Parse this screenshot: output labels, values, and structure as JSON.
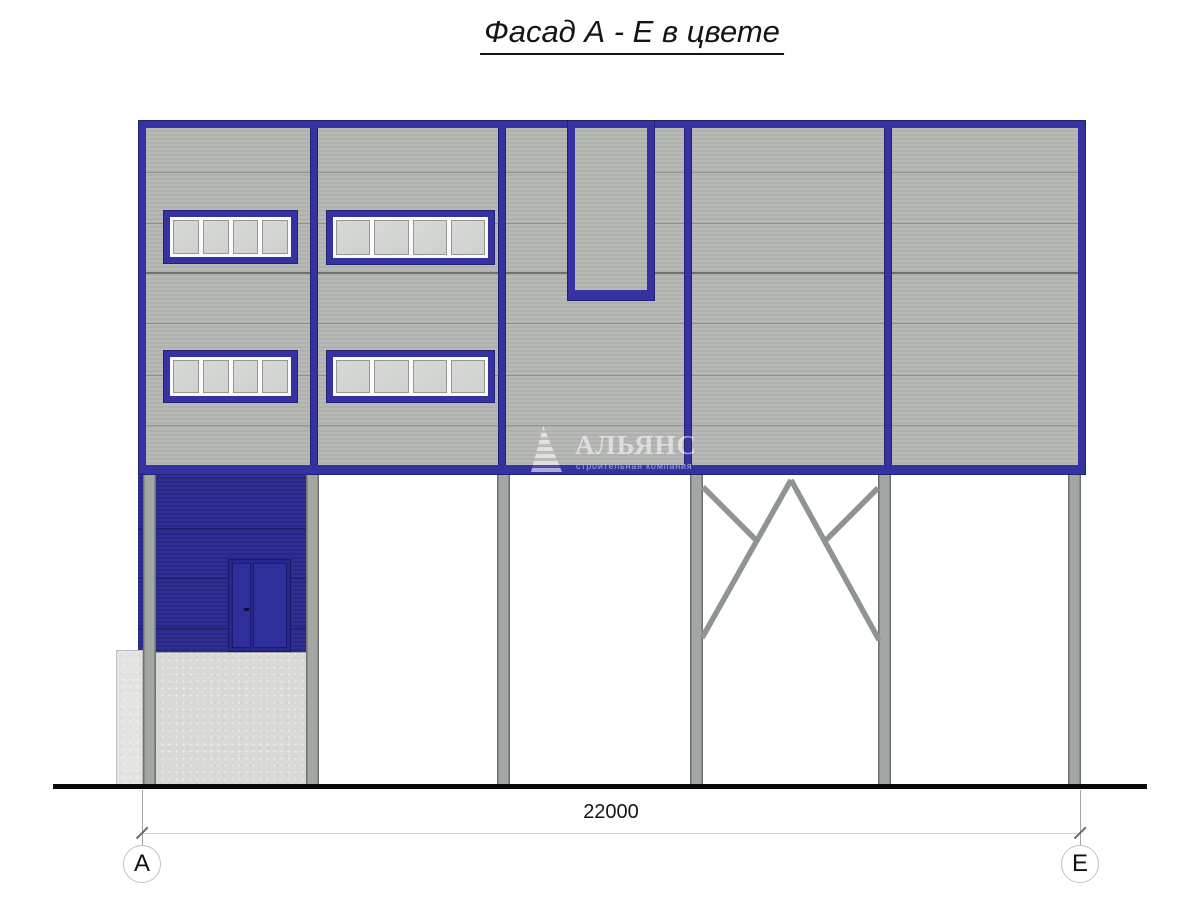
{
  "title": "Фасад А - Е в цвете",
  "drawing": {
    "type": "facade-elevation",
    "dimension": {
      "value": "22000"
    },
    "grid_markers": {
      "left": "А",
      "right": "Е"
    },
    "watermark": {
      "name": "АЛЬЯНС",
      "subtitle": "строительная компания"
    },
    "features": {
      "window_count": 4,
      "panes_per_window": 4,
      "support_columns": 6,
      "has_cross_bracing": true,
      "has_entrance_door": true
    }
  },
  "colors": {
    "frame_blue": "#3533a1",
    "frame_blue_dark": "#232270",
    "annex_blue": "#2b2b90",
    "door_blue": "#2f2f9b",
    "facade_gray": "#b2b5b1",
    "panel_line_gray": "#8d908d",
    "column_gray": "#a3a7a3",
    "brace_gray": "#8e948f",
    "concrete_gray": "#d9d9d7",
    "ground_black": "#0a0a0a",
    "dimension_gray": "#d0d0d0",
    "background": "#ffffff"
  }
}
